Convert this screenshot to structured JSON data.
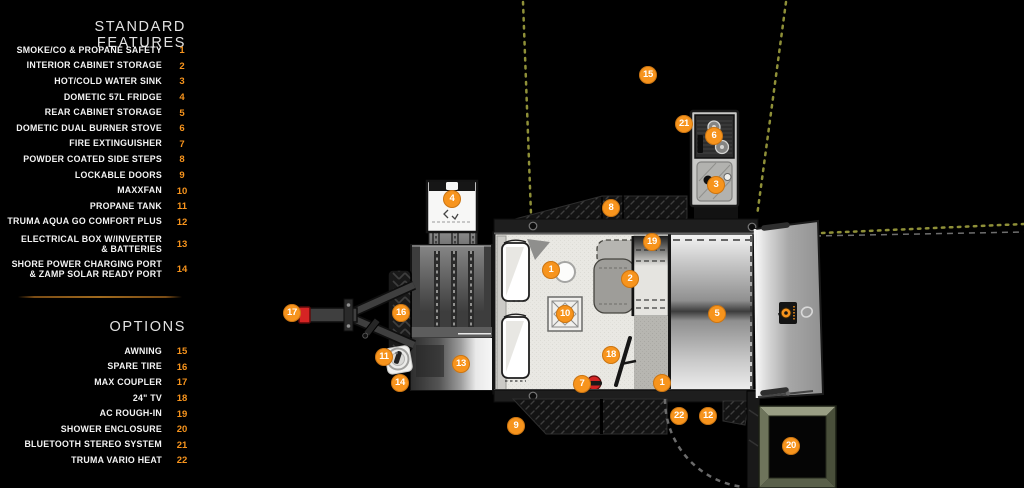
{
  "palette": {
    "accent": "#F7941D",
    "background": "#000000",
    "text": "#F2F2F2",
    "awning_dots": "#8F9038",
    "shower_frame": "#5A604A",
    "alert_red": "#D32222"
  },
  "legend": {
    "standard_features": {
      "title": "STANDARD FEATURES",
      "items": [
        {
          "num": "1",
          "label": "SMOKE/CO & PROPANE SAFETY"
        },
        {
          "num": "2",
          "label": "INTERIOR CABINET STORAGE"
        },
        {
          "num": "3",
          "label": "HOT/COLD WATER SINK"
        },
        {
          "num": "4",
          "label": "DOMETIC 57L FRIDGE"
        },
        {
          "num": "5",
          "label": "REAR CABINET STORAGE"
        },
        {
          "num": "6",
          "label": "DOMETIC DUAL BURNER STOVE"
        },
        {
          "num": "7",
          "label": "FIRE EXTINGUISHER"
        },
        {
          "num": "8",
          "label": "POWDER COATED SIDE STEPS"
        },
        {
          "num": "9",
          "label": "LOCKABLE DOORS"
        },
        {
          "num": "10",
          "label": "MAXXFAN"
        },
        {
          "num": "11",
          "label": "PROPANE TANK"
        },
        {
          "num": "12",
          "label": "TRUMA AQUA GO COMFORT PLUS"
        },
        {
          "num": "13",
          "label": "ELECTRICAL BOX W/INVERTER\n& BATTERIES",
          "cls": "two"
        },
        {
          "num": "14",
          "label": "SHORE POWER CHARGING PORT\n& ZAMP SOLAR READY PORT",
          "cls": "two"
        }
      ]
    },
    "options": {
      "title": "OPTIONS",
      "items": [
        {
          "num": "15",
          "label": "AWNING"
        },
        {
          "num": "16",
          "label": "SPARE TIRE"
        },
        {
          "num": "17",
          "label": "MAX COUPLER"
        },
        {
          "num": "18",
          "label": "24\" TV"
        },
        {
          "num": "19",
          "label": "AC ROUGH-IN"
        },
        {
          "num": "20",
          "label": "SHOWER ENCLOSURE"
        },
        {
          "num": "21",
          "label": "BLUETOOTH STEREO SYSTEM"
        },
        {
          "num": "22",
          "label": "TRUMA VARIO HEAT"
        }
      ]
    }
  },
  "plan": {
    "markers": [
      {
        "n": "1",
        "x": 551,
        "y": 270
      },
      {
        "n": "1",
        "x": 662,
        "y": 383
      },
      {
        "n": "2",
        "x": 630,
        "y": 279
      },
      {
        "n": "3",
        "x": 716,
        "y": 185
      },
      {
        "n": "4",
        "x": 452,
        "y": 199
      },
      {
        "n": "5",
        "x": 717,
        "y": 314
      },
      {
        "n": "6",
        "x": 714,
        "y": 136
      },
      {
        "n": "7",
        "x": 582,
        "y": 384
      },
      {
        "n": "8",
        "x": 611,
        "y": 208
      },
      {
        "n": "9",
        "x": 516,
        "y": 426
      },
      {
        "n": "10",
        "x": 565,
        "y": 314
      },
      {
        "n": "11",
        "x": 384,
        "y": 357
      },
      {
        "n": "12",
        "x": 708,
        "y": 416
      },
      {
        "n": "13",
        "x": 461,
        "y": 364
      },
      {
        "n": "14",
        "x": 400,
        "y": 383
      },
      {
        "n": "15",
        "x": 648,
        "y": 75
      },
      {
        "n": "16",
        "x": 401,
        "y": 313
      },
      {
        "n": "17",
        "x": 292,
        "y": 313
      },
      {
        "n": "18",
        "x": 611,
        "y": 355
      },
      {
        "n": "19",
        "x": 652,
        "y": 242
      },
      {
        "n": "20",
        "x": 791,
        "y": 446
      },
      {
        "n": "21",
        "x": 684,
        "y": 124
      },
      {
        "n": "22",
        "x": 679,
        "y": 416
      }
    ]
  }
}
